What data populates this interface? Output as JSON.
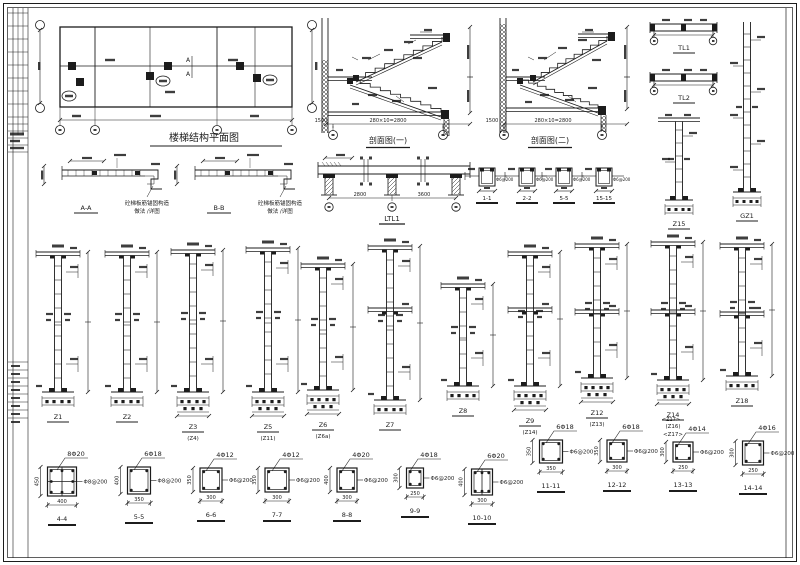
{
  "meta": {
    "bg": "#ffffff",
    "ink": "#1c1c1c",
    "drawing_type": "structural stair / column reinforcement CAD sheet"
  },
  "plan": {
    "title": "楼梯结构平面图",
    "section_mark": "A"
  },
  "stairs": [
    {
      "title": "剖面图(一)",
      "run_dim": "280×10=2800",
      "landing_dim": "1500"
    },
    {
      "title": "剖面图(二)",
      "run_dim": "280×10=2800",
      "landing_dim": "1500"
    }
  ],
  "beam_elev": {
    "label": "LTL1",
    "span1": "2800",
    "span2": "3600"
  },
  "beam_sections": [
    {
      "label": "1-1",
      "stirrup": "Φ6@200"
    },
    {
      "label": "2-2",
      "stirrup": "Φ6@200"
    },
    {
      "label": "5-5",
      "stirrup": "Φ6@200"
    },
    {
      "label": "15-15",
      "stirrup": "Φ6@200"
    }
  ],
  "top_beams": [
    {
      "label": "TL1"
    },
    {
      "label": "TL2"
    }
  ],
  "right_columns": [
    {
      "label": "Z15"
    },
    {
      "label": "GZ1"
    }
  ],
  "details": [
    {
      "label": "A-A",
      "note1": "砼梯板筋锚固构造",
      "note2": "做法 /详图"
    },
    {
      "label": "B-B",
      "note1": "砼梯板筋锚固构造",
      "note2": "做法 /详图"
    }
  ],
  "columns": [
    {
      "label": "Z1",
      "sub": "",
      "sub2": ""
    },
    {
      "label": "Z2",
      "sub": "",
      "sub2": ""
    },
    {
      "label": "Z3",
      "sub": "(Z4)",
      "sub2": ""
    },
    {
      "label": "Z5",
      "sub": "(Z11)",
      "sub2": ""
    },
    {
      "label": "Z6",
      "sub": "(Z6a)",
      "sub2": ""
    },
    {
      "label": "Z7",
      "sub": "",
      "sub2": ""
    },
    {
      "label": "Z8",
      "sub": "",
      "sub2": ""
    },
    {
      "label": "Z9",
      "sub": "(Z14)",
      "sub2": ""
    },
    {
      "label": "Z12",
      "sub": "(Z13)",
      "sub2": ""
    },
    {
      "label": "Z14",
      "sub": "(Z16)",
      "sub2": "<Z17>"
    },
    {
      "label": "Z18",
      "sub": "",
      "sub2": ""
    }
  ],
  "sections": [
    {
      "label": "4-4",
      "rebar": "8Φ20",
      "stirrup": "Φ8@200",
      "w": "400",
      "h": "450",
      "tag": ""
    },
    {
      "label": "5-5",
      "rebar": "6Φ18",
      "stirrup": "Φ8@200",
      "w": "350",
      "h": "400",
      "tag": ""
    },
    {
      "label": "6-6",
      "rebar": "4Φ12",
      "stirrup": "Φ6@200",
      "w": "300",
      "h": "350",
      "tag": ""
    },
    {
      "label": "7-7",
      "rebar": "4Φ12",
      "stirrup": "Φ6@200",
      "w": "300",
      "h": "350",
      "tag": ""
    },
    {
      "label": "8-8",
      "rebar": "4Φ20",
      "stirrup": "Φ6@200",
      "w": "300",
      "h": "400",
      "tag": ""
    },
    {
      "label": "9-9",
      "rebar": "4Φ18",
      "stirrup": "Φ6@200",
      "w": "250",
      "h": "300",
      "tag": ""
    },
    {
      "label": "10-10",
      "rebar": "6Φ20",
      "stirrup": "Φ6@200",
      "w": "300",
      "h": "400",
      "tag": ""
    },
    {
      "label": "11-11",
      "rebar": "6Φ18",
      "stirrup": "Φ6@200",
      "w": "350",
      "h": "350",
      "tag": ""
    },
    {
      "label": "12-12",
      "rebar": "6Φ18",
      "stirrup": "Φ6@200",
      "w": "300",
      "h": "350",
      "tag": ""
    },
    {
      "label": "13-13",
      "rebar": "4Φ14",
      "stirrup": "Φ6@200",
      "w": "250",
      "h": "300",
      "tag": "<Z17>"
    },
    {
      "label": "14-14",
      "rebar": "4Φ16",
      "stirrup": "Φ6@200",
      "w": "250",
      "h": "300",
      "tag": ""
    }
  ]
}
